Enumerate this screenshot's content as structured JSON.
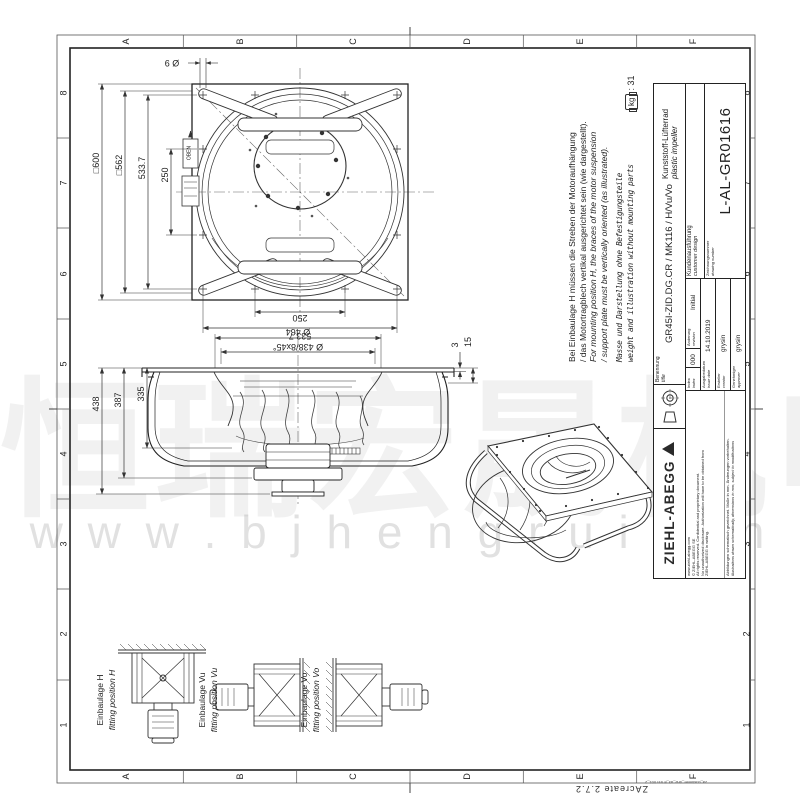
{
  "colors": {
    "line": "#2b2b2b",
    "watermark_gray": "#ededed"
  },
  "watermark": {
    "cjk": "恒瑞宏晟机电",
    "url": "w w w . b j h e n g r u i . c n"
  },
  "grid": {
    "letters": [
      "A",
      "B",
      "C",
      "D",
      "E",
      "F"
    ],
    "numbers": [
      "8",
      "7",
      "6",
      "5",
      "4",
      "3",
      "2",
      "1"
    ]
  },
  "footer": {
    "app": "ZAcreate  2.7.2",
    "template": "za_customer_drw_a3_E trin 001_2"
  },
  "notes": {
    "de1": "Bei Einbaulage H müssen die Streben der Motoraufhängung",
    "de2": "/ das Motortragblech vertikal ausgerichtet sein (wie dargestellt).",
    "en1": "For mounting position H, the braces of the motor suspension",
    "en2": "/ support plate must be vertically oriented (as illustrated).",
    "mass_de": "Masse und Darstellung ohne Befestigungsteile",
    "mass_en": "weight and illustration without mounting parts",
    "weight_unit": "kg",
    "weight_value": ": 31"
  },
  "dims": {
    "top": {
      "sq600": "□600",
      "sq562": "□562",
      "d5337_left": "533.7",
      "d250_left": "250",
      "d9": "Ø 9",
      "d250_bottom": "250",
      "d5337_bottom": "533.7",
      "oben": "OBEN"
    },
    "section": {
      "d464": "Ø 464",
      "d438c": "Ø 438/8x45°",
      "d3": "3",
      "d15": "15",
      "d438": "438",
      "d387": "387",
      "d335": "335"
    }
  },
  "fitting": {
    "h_de": "Einbaulage H",
    "h_en": "fitting position H",
    "vu_de": "Einbaulage Vu",
    "vu_en": "fitting position Vu",
    "vo_de": "Einbaulage Vo",
    "vo_en": "fitting position Vo"
  },
  "title_block": {
    "brand": "ZIEHL-ABEGG",
    "legal": [
      "www.ziehl-abegg.com",
      "© ZIEHL-ABEGG SE",
      "All rights reserved. Confidential and proprietary document.",
      "No unauthorized disclosure. Authorization will have to be obtained from",
      "ZIEHL-ABEGG in writing."
    ],
    "disclaimer_de": "Abbildungen schematisch gezeichnet. Maße in mm. Änderungen vorbehalten.",
    "disclaimer_en": "illustrations drawn schematically, dimensions in mm, subject to modifications",
    "benennung": "Benennung",
    "title_en": "title",
    "name": "GR45I-ZID.DG.CR / MK116 / H/Vu/Vo",
    "product_de": "Kunststoff-Lüfterrad",
    "product_en": "plastic impeller",
    "index_de": "Index",
    "index_en": "index",
    "index_value": "000",
    "rev_de": "Änderung",
    "rev_en": "revision",
    "rev_value": "Initial",
    "date_de": "Ausgabedatum",
    "date_en": "issue date",
    "date_value": "14.10.2019",
    "creator_de": "Ersteller",
    "creator_en": "creator",
    "creator_value": "grysin",
    "approver_de": "Genehmiger",
    "approver_en": "approver",
    "approver_value": "grysin",
    "customer_de": "Kundenausführung",
    "customer_en": "customer design",
    "dwgno_de": "Zeichnungsnummer",
    "dwgno_en": "drawing number",
    "dwgno_value": "L-AL-GR01616"
  }
}
